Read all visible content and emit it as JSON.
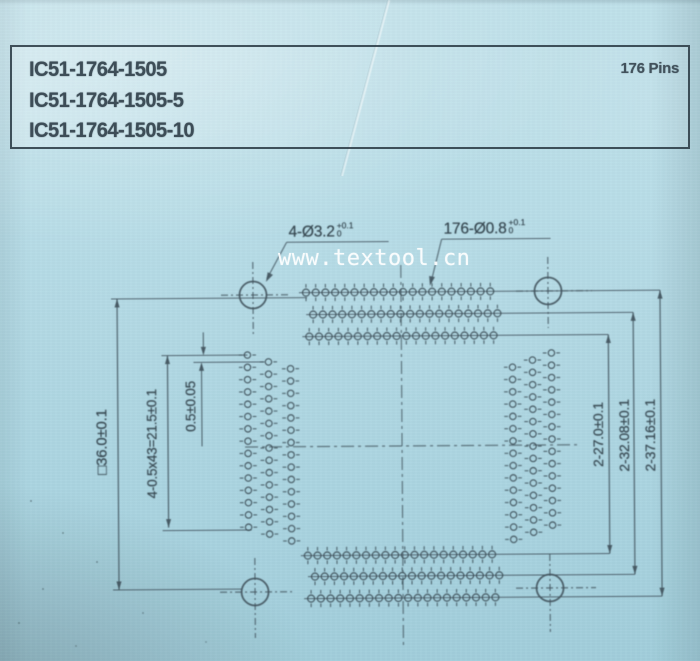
{
  "header": {
    "part_numbers": [
      "IC51-1764-1505",
      "IC51-1764-1505-5",
      "IC51-1764-1505-10"
    ],
    "pins_label": "176 Pins"
  },
  "watermark": "www.textool.cn",
  "callouts": {
    "mounting_holes": {
      "text": "4-Ø3.2",
      "tol_plus": "+0.1",
      "tol_minus": "0"
    },
    "pin_holes": {
      "text": "176-Ø0.8",
      "tol_plus": "+0.1",
      "tol_minus": "0"
    }
  },
  "dimensions": {
    "body_square": "□36.0±0.1",
    "pin_span": "4-0.5x43=21.5±0.1",
    "row_offset": "0.5±0.05",
    "inner_span": "2-27.0±0.1",
    "middle_span": "2-32.08±0.1",
    "outer_span": "2-37.16±0.1"
  },
  "colors": {
    "ink": "#35464f",
    "line": "#42545e",
    "paper": "#b1d8e3",
    "watermark": "#ffffff"
  },
  "drawing": {
    "pin_arrays": [
      {
        "name": "top-pin-row-1",
        "orient": "row",
        "fixed": 293,
        "start": 306,
        "count": 20,
        "pitch": 9.7,
        "r": 3.5
      },
      {
        "name": "top-pin-row-2",
        "orient": "row",
        "fixed": 315,
        "start": 313,
        "count": 20,
        "pitch": 9.7,
        "r": 3.5
      },
      {
        "name": "top-pin-row-3",
        "orient": "row",
        "fixed": 337,
        "start": 309,
        "count": 20,
        "pitch": 9.7,
        "r": 3.5
      },
      {
        "name": "bottom-pin-row-1",
        "orient": "row",
        "fixed": 556,
        "start": 306,
        "count": 20,
        "pitch": 9.7,
        "r": 3.5
      },
      {
        "name": "bottom-pin-row-2",
        "orient": "row",
        "fixed": 577,
        "start": 313,
        "count": 20,
        "pitch": 9.7,
        "r": 3.5
      },
      {
        "name": "bottom-pin-row-3",
        "orient": "row",
        "fixed": 599,
        "start": 309,
        "count": 20,
        "pitch": 9.7,
        "r": 3.5
      },
      {
        "name": "left-pin-col-1",
        "orient": "col",
        "fixed": 247,
        "start": 355,
        "count": 15,
        "pitch": 12.3,
        "r": 3.2
      },
      {
        "name": "left-pin-col-2",
        "orient": "col",
        "fixed": 268,
        "start": 362,
        "count": 15,
        "pitch": 12.3,
        "r": 3.2
      },
      {
        "name": "left-pin-col-3",
        "orient": "col",
        "fixed": 290,
        "start": 369,
        "count": 15,
        "pitch": 12.3,
        "r": 3.2
      },
      {
        "name": "right-pin-col-1",
        "orient": "col",
        "fixed": 512,
        "start": 369,
        "count": 15,
        "pitch": 12.3,
        "r": 3.2
      },
      {
        "name": "right-pin-col-2",
        "orient": "col",
        "fixed": 532,
        "start": 362,
        "count": 15,
        "pitch": 12.3,
        "r": 3.2
      },
      {
        "name": "right-pin-col-3",
        "orient": "col",
        "fixed": 551,
        "start": 355,
        "count": 15,
        "pitch": 12.3,
        "r": 3.2
      }
    ]
  }
}
